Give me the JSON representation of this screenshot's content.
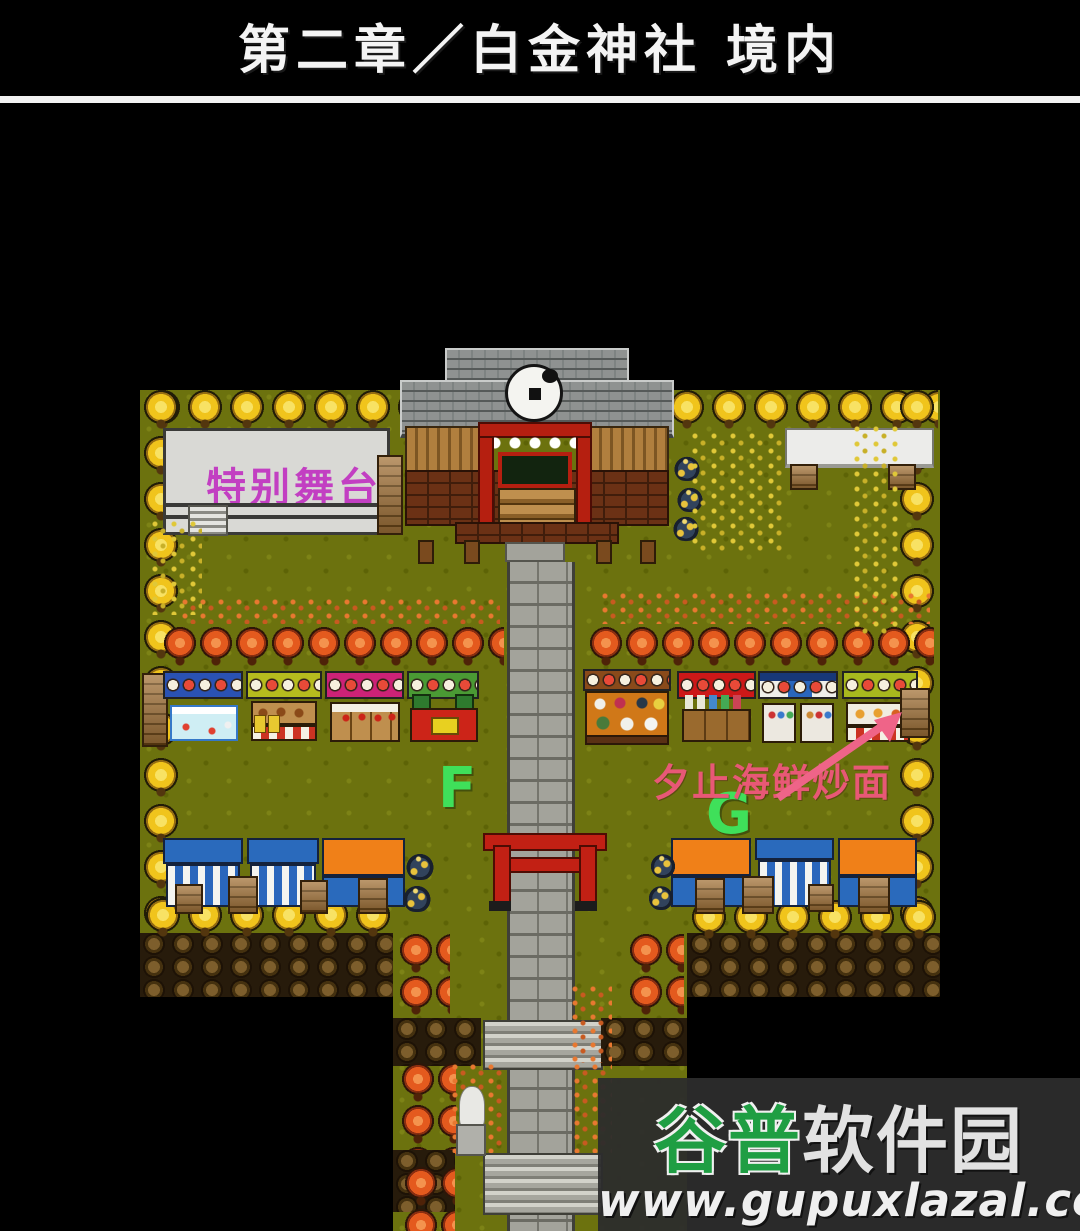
{
  "header": {
    "title": "第二章／白金神社 境内"
  },
  "map": {
    "stage_label": "特别舞台",
    "marker_f": "F",
    "marker_g": "G",
    "annotation_text": "夕止海鲜炒面"
  },
  "watermark": {
    "brand_green": "谷普",
    "brand_rest": "软件园",
    "url": "www.gupuxlazal.com"
  },
  "colors": {
    "background": "#000000",
    "grass": "#6c720e",
    "stage_label_magenta": "#c23fc2",
    "marker_green": "#3fe05a",
    "annotation_pink": "#e85876",
    "watermark_green": "#1f9e43",
    "torii_red": "#c22014",
    "path_gray": "#a3a39b"
  }
}
